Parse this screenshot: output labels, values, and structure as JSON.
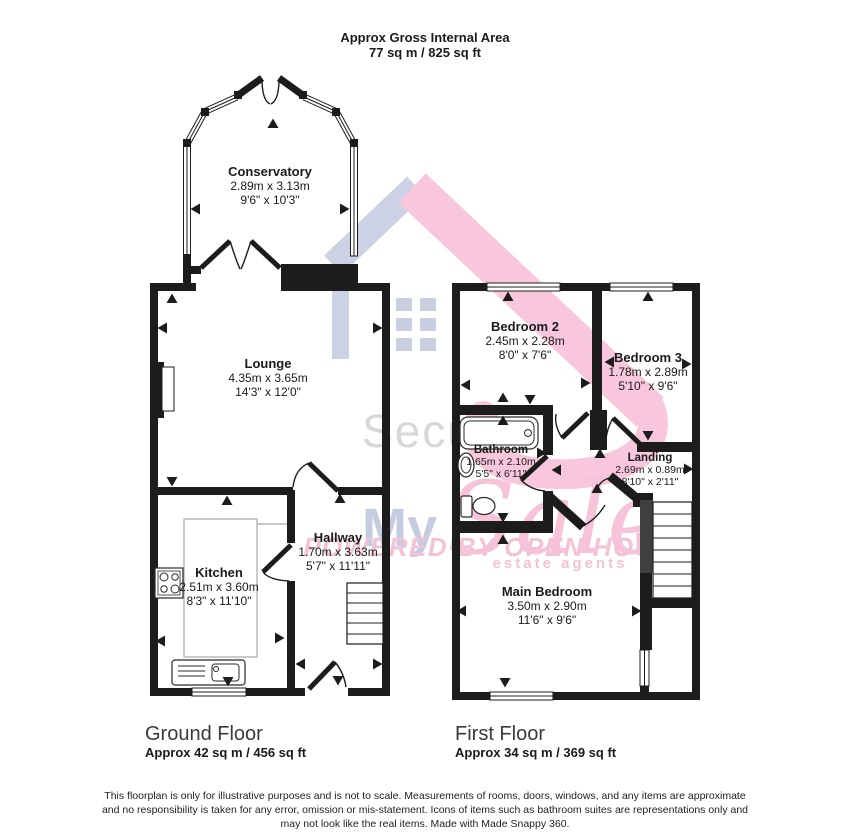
{
  "title": {
    "line1": "Approx Gross Internal Area",
    "line2": "77 sq m / 825 sq ft"
  },
  "watermark": {
    "secure": "Secure",
    "my": "My",
    "sale": "Sale",
    "powered": "POWERED BY OPEN HOUSE",
    "mark": "‖",
    "tagline": "estate agents"
  },
  "ground_floor": {
    "label": "Ground Floor",
    "area": "Approx 42 sq m / 456 sq ft",
    "rooms": {
      "conservatory": {
        "name": "Conservatory",
        "metric": "2.89m x 3.13m",
        "imperial": "9'6\" x 10'3\""
      },
      "lounge": {
        "name": "Lounge",
        "metric": "4.35m x 3.65m",
        "imperial": "14'3\" x 12'0\""
      },
      "kitchen": {
        "name": "Kitchen",
        "metric": "2.51m x 3.60m",
        "imperial": "8'3\" x 11'10\""
      },
      "hallway": {
        "name": "Hallway",
        "metric": "1.70m x 3.63m",
        "imperial": "5'7\" x 11'11\""
      }
    }
  },
  "first_floor": {
    "label": "First Floor",
    "area": "Approx 34 sq m / 369 sq ft",
    "rooms": {
      "bedroom2": {
        "name": "Bedroom 2",
        "metric": "2.45m x 2.28m",
        "imperial": "8'0\" x 7'6\""
      },
      "bedroom3": {
        "name": "Bedroom 3",
        "metric": "1.78m x 2.89m",
        "imperial": "5'10\" x 9'6\""
      },
      "bathroom": {
        "name": "Bathroom",
        "metric": "1.65m x 2.10m",
        "imperial": "5'5\" x 6'11\""
      },
      "landing": {
        "name": "Landing",
        "metric": "2.69m x 0.89m",
        "imperial": "8'10\" x 2'11\""
      },
      "main_bedroom": {
        "name": "Main Bedroom",
        "metric": "3.50m x 2.90m",
        "imperial": "11'6\" x 9'6\""
      }
    }
  },
  "footer": {
    "line1": "This floorplan is only for illustrative purposes and is not to scale. Measurements of rooms, doors, windows, and any items are approximate",
    "line2": "and no responsibility is taken for any error, omission or mis-statement. Icons of items such as bathroom suites are representations only and",
    "line3": "may not look like the real items. Made with Made Snappy 360."
  },
  "colors": {
    "wall": "#1c1c1c",
    "text": "#1a1a1a",
    "watermark_pink": "#f6c3d8",
    "watermark_blue": "#c6ccdf",
    "watermark_gray": "#d8d8d8",
    "counter_gray": "#b5b5b5"
  }
}
